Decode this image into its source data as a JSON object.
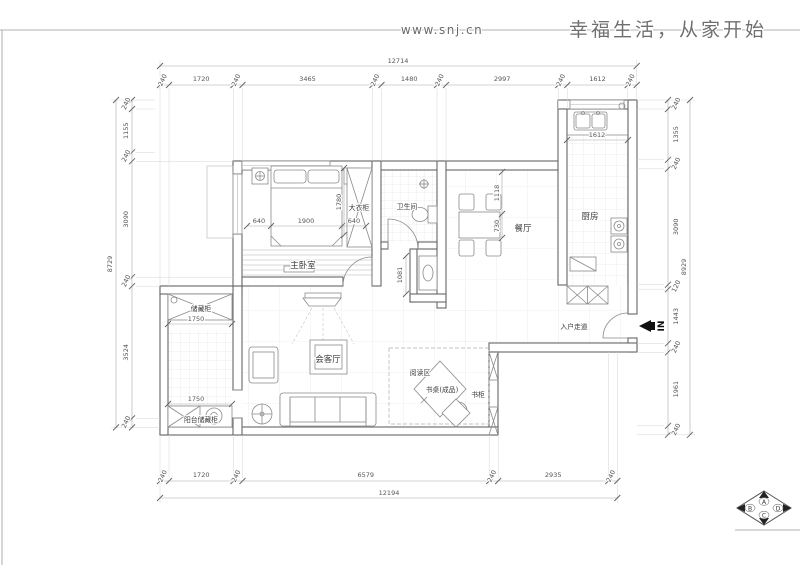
{
  "header": {
    "url": "www.snj.cn",
    "slogan": "幸福生活，从家开始"
  },
  "dims": {
    "top": {
      "total": "12714",
      "segments": [
        "240",
        "1720",
        "240",
        "3465",
        "240",
        "1480",
        "240",
        "2997",
        "240",
        "1612",
        "240"
      ]
    },
    "bottom": {
      "total": "12194",
      "segments": [
        "240",
        "1720",
        "240",
        "6579",
        "240",
        "2935",
        "240"
      ]
    },
    "left": {
      "total": "8729",
      "segments": [
        "240",
        "1155",
        "240",
        "3090",
        "240",
        "3524",
        "240"
      ]
    },
    "right": {
      "total": "8929",
      "segments": [
        "240",
        "1355",
        "240",
        "3090",
        "120",
        "1443",
        "240",
        "1961",
        "240"
      ]
    },
    "bedroom": {
      "left": "640",
      "bed": "1900",
      "right": "640",
      "wardrobe": "1780"
    },
    "dining": {
      "a": "1118",
      "b": "730"
    },
    "kitchen": {
      "sink": "1612"
    },
    "vanity": "1081",
    "balcony": {
      "top": "1750",
      "bottom": "1750"
    }
  },
  "labels": {
    "master_bedroom": "主卧室",
    "wardrobe": "大衣柜",
    "bathroom": "卫生间",
    "dining": "餐厅",
    "kitchen": "厨房",
    "living": "会客厅",
    "reading": "阅读区",
    "desk": "书桌(成品)",
    "bookcase": "书柜",
    "entry": "入户走道",
    "storage": "储藏柜",
    "balcony_storage": "阳台储藏柜",
    "entrance": "IN"
  },
  "compass": {
    "a": "A",
    "b": "B",
    "c": "C",
    "d": "D"
  }
}
